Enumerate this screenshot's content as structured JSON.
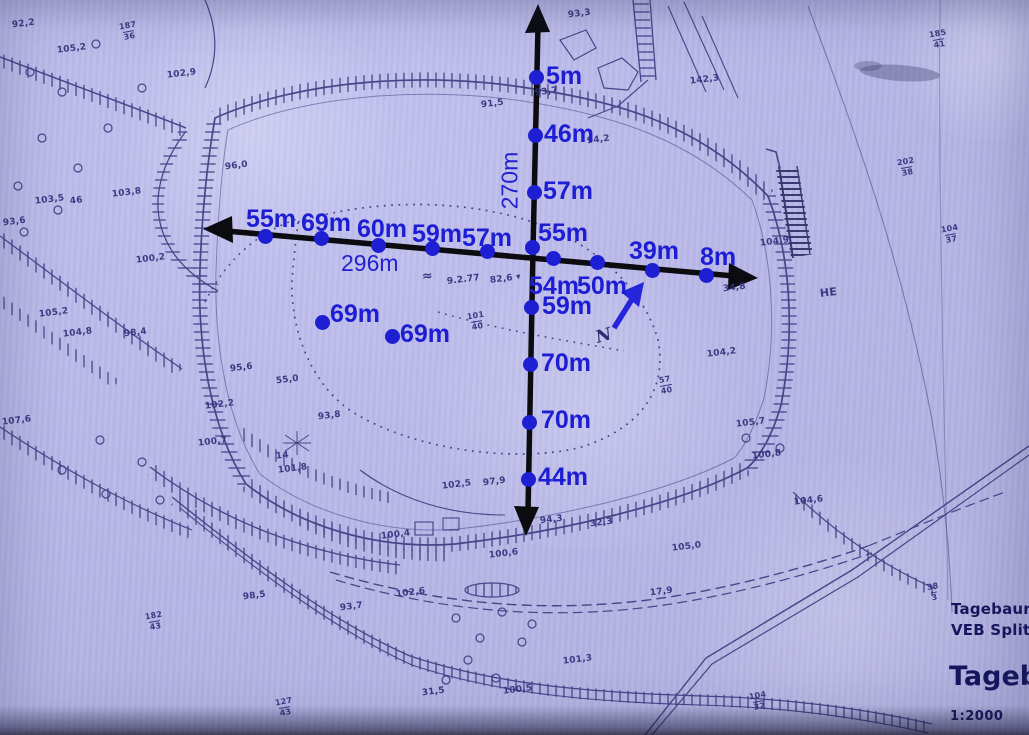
{
  "colors": {
    "paper": "#b8b7e7",
    "map_ink": "#32327a",
    "arrow_black": "#0b0b10",
    "annotation_blue": "#1e1ed2"
  },
  "annotations": {
    "north_label": "N",
    "vertical": {
      "length_label": "270m",
      "points": [
        {
          "label": "5m",
          "x": 536,
          "y": 77,
          "lx": 546,
          "ly": 62
        },
        {
          "label": "46m",
          "x": 535,
          "y": 135,
          "lx": 544,
          "ly": 120
        },
        {
          "label": "57m",
          "x": 534,
          "y": 192,
          "lx": 543,
          "ly": 177
        },
        {
          "label": "55m",
          "x": 532,
          "y": 247,
          "lx": 538,
          "ly": 219
        },
        {
          "label": "59m",
          "x": 531,
          "y": 307,
          "lx": 542,
          "ly": 292
        },
        {
          "label": "70m",
          "x": 530,
          "y": 364,
          "lx": 541,
          "ly": 349
        },
        {
          "label": "70m",
          "x": 529,
          "y": 422,
          "lx": 541,
          "ly": 406
        },
        {
          "label": "44m",
          "x": 528,
          "y": 479,
          "lx": 538,
          "ly": 463
        }
      ]
    },
    "horizontal": {
      "length_label": "296m",
      "points": [
        {
          "label": "55m",
          "x": 265,
          "y": 236,
          "lx": 246,
          "ly": 205
        },
        {
          "label": "69m",
          "x": 321,
          "y": 238,
          "lx": 301,
          "ly": 209
        },
        {
          "label": "60m",
          "x": 378,
          "y": 245,
          "lx": 357,
          "ly": 215
        },
        {
          "label": "59m",
          "x": 432,
          "y": 248,
          "lx": 412,
          "ly": 220
        },
        {
          "label": "57m",
          "x": 487,
          "y": 251,
          "lx": 462,
          "ly": 224
        },
        {
          "label": "54m",
          "x": 553,
          "y": 258,
          "lx": 529,
          "ly": 272
        },
        {
          "label": "50m",
          "x": 597,
          "y": 262,
          "lx": 577,
          "ly": 272
        },
        {
          "label": "39m",
          "x": 652,
          "y": 270,
          "lx": 629,
          "ly": 237
        },
        {
          "label": "8m",
          "x": 706,
          "y": 275,
          "lx": 700,
          "ly": 243
        }
      ]
    },
    "extra_points": [
      {
        "label": "69m",
        "x": 322,
        "y": 322,
        "lx": 330,
        "ly": 300
      },
      {
        "label": "69m",
        "x": 392,
        "y": 336,
        "lx": 400,
        "ly": 320
      }
    ]
  },
  "scan_labels": [
    {
      "t": "92,2",
      "x": 12,
      "y": 20
    },
    {
      "t": "105,2",
      "x": 57,
      "y": 45
    },
    {
      "t": "187/36",
      "x": 120,
      "y": 22
    },
    {
      "t": "102,9",
      "x": 167,
      "y": 70
    },
    {
      "t": "93,3",
      "x": 568,
      "y": 10
    },
    {
      "t": "91,5",
      "x": 481,
      "y": 100
    },
    {
      "t": "93,7",
      "x": 535,
      "y": 88
    },
    {
      "t": "94,2",
      "x": 587,
      "y": 136
    },
    {
      "t": "142,3",
      "x": 690,
      "y": 76
    },
    {
      "t": "96,0",
      "x": 225,
      "y": 162
    },
    {
      "t": "103,5",
      "x": 35,
      "y": 196
    },
    {
      "t": "103,8",
      "x": 112,
      "y": 189
    },
    {
      "t": "46",
      "x": 70,
      "y": 197
    },
    {
      "t": "93,6",
      "x": 3,
      "y": 218
    },
    {
      "t": "100,2",
      "x": 136,
      "y": 255
    },
    {
      "t": "105,2",
      "x": 39,
      "y": 309
    },
    {
      "t": "104,8",
      "x": 63,
      "y": 329
    },
    {
      "t": "98,4",
      "x": 124,
      "y": 329
    },
    {
      "t": "107,6",
      "x": 2,
      "y": 417
    },
    {
      "t": "102,2",
      "x": 205,
      "y": 401
    },
    {
      "t": "100,7",
      "x": 198,
      "y": 438
    },
    {
      "t": "95,6",
      "x": 230,
      "y": 364
    },
    {
      "t": "55,0",
      "x": 276,
      "y": 376
    },
    {
      "t": "93,8",
      "x": 318,
      "y": 412
    },
    {
      "t": "101,8",
      "x": 278,
      "y": 465
    },
    {
      "t": "14",
      "x": 276,
      "y": 452
    },
    {
      "t": "102,5",
      "x": 442,
      "y": 481
    },
    {
      "t": "97,9",
      "x": 483,
      "y": 478
    },
    {
      "t": "≈",
      "x": 422,
      "y": 270,
      "fs": 13
    },
    {
      "t": "9.2.77",
      "x": 447,
      "y": 276
    },
    {
      "t": "82,6 ▾",
      "x": 490,
      "y": 275
    },
    {
      "t": "101/40",
      "x": 468,
      "y": 312
    },
    {
      "t": "57/40",
      "x": 660,
      "y": 376
    },
    {
      "t": "104,2",
      "x": 707,
      "y": 349
    },
    {
      "t": "34,8",
      "x": 723,
      "y": 284
    },
    {
      "t": "104,9",
      "x": 760,
      "y": 238
    },
    {
      "t": "HE",
      "x": 820,
      "y": 287,
      "fs": 11
    },
    {
      "t": "105,7",
      "x": 736,
      "y": 419
    },
    {
      "t": "100,8",
      "x": 752,
      "y": 451
    },
    {
      "t": "104,6",
      "x": 794,
      "y": 497
    },
    {
      "t": "185/41",
      "x": 930,
      "y": 30
    },
    {
      "t": "202/38",
      "x": 898,
      "y": 158
    },
    {
      "t": "104/37",
      "x": 942,
      "y": 225
    },
    {
      "t": "38/3",
      "x": 928,
      "y": 583
    },
    {
      "t": "182/43",
      "x": 146,
      "y": 612
    },
    {
      "t": "127/43",
      "x": 276,
      "y": 698
    },
    {
      "t": "104/32",
      "x": 750,
      "y": 692
    },
    {
      "t": "98,5",
      "x": 243,
      "y": 592
    },
    {
      "t": "93,7",
      "x": 340,
      "y": 603
    },
    {
      "t": "102,6",
      "x": 396,
      "y": 589
    },
    {
      "t": "94,3",
      "x": 540,
      "y": 516
    },
    {
      "t": "32,3",
      "x": 590,
      "y": 519
    },
    {
      "t": "100,4",
      "x": 381,
      "y": 531
    },
    {
      "t": "100,6",
      "x": 489,
      "y": 550
    },
    {
      "t": "105,0",
      "x": 672,
      "y": 543
    },
    {
      "t": "101,3",
      "x": 563,
      "y": 656
    },
    {
      "t": "100,5",
      "x": 503,
      "y": 686
    },
    {
      "t": "31,5",
      "x": 422,
      "y": 688
    },
    {
      "t": "17,9",
      "x": 650,
      "y": 588
    }
  ],
  "title_block": {
    "line1": "Tagebaurest",
    "line2": "VEB Splittw",
    "line3": "Tagebau",
    "scale": "1:2000"
  }
}
